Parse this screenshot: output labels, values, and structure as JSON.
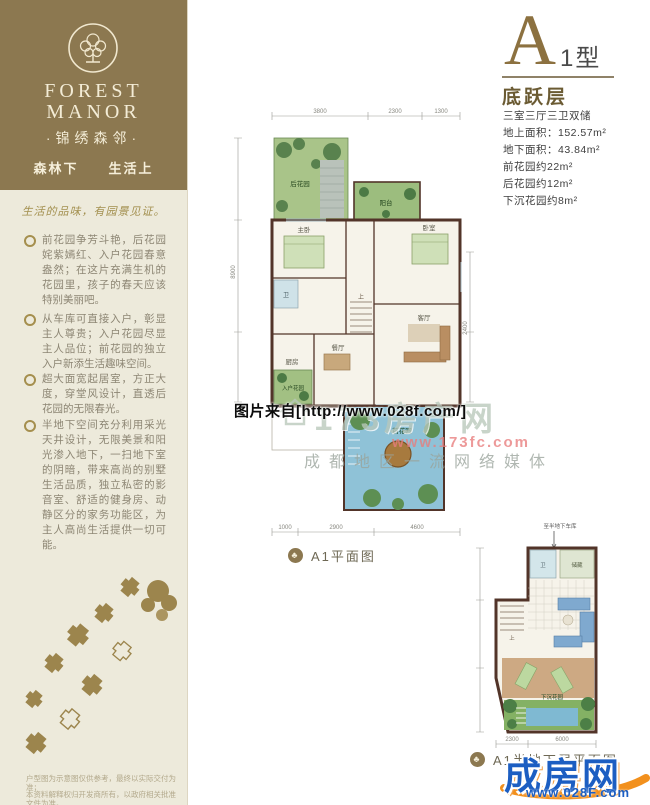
{
  "sidebar": {
    "brand_en_1": "FOREST",
    "brand_en_2": "MANOR",
    "brand_cn": "·锦绣森邻·",
    "tagline": "森林下　　生活上",
    "script_line": "生活的品味，有园景见证。",
    "bullets": [
      "前花园争芳斗艳，后花园姹紫嫣红、入户花园春意盎然；在这片充满生机的花园里，孩子的春天应该特别美丽吧。",
      "从车库可直接入户，彰显主人尊贵；入户花园尽显主人品位；前花园的独立入户新添生活趣味空间。",
      "超大面宽起居室，方正大度，穿堂风设计，直透后花园的无限春光。",
      "半地下空间充分利用采光天井设计，无限美景和阳光渗入地下，一扫地下室的阴暗，带来高尚的别墅生活品质，独立私密的影音室、舒适的健身房、动静区分的家务功能区，为主人高尚生活提供一切可能。"
    ],
    "disclaimers": [
      "户型图为示意图仅供参考，最终以实际交付为准；",
      "本资料解释权归开发商所有，以政府相关批准文件为准。"
    ]
  },
  "unit": {
    "letter": "A",
    "type": "1型",
    "floor": "底跃层",
    "specs": [
      "三室三厅三卫双储",
      "地上面积：152.57m²",
      "地下面积：43.84m²",
      "前花园约22m²",
      "后花园约12m²",
      "下沉花园约8m²"
    ]
  },
  "plan_main": {
    "caption": "A1平面图",
    "emblem_glyph": "♣",
    "rooms": {
      "back_garden": "后花园",
      "balcony": "阳台",
      "master": "主卧",
      "bedroom": "卧室",
      "bath": "卫",
      "dining": "餐厅",
      "living": "客厅",
      "kitchen": "厨房",
      "entry_garden": "入户花园",
      "front_garden": "前花园",
      "stairs_up": "上"
    },
    "dims_top": [
      "3800",
      "2300",
      "1300"
    ],
    "dims_bottom": [
      "1000",
      "2900",
      "4600"
    ],
    "dims_left": [
      "8900"
    ],
    "dims_right": [
      "2400"
    ]
  },
  "plan_basement": {
    "caption": "A1半地下层平面图",
    "top_note": "至半地下车库",
    "stairs_up": "上",
    "rooms": {
      "bath": "卫",
      "storage": "储藏",
      "sunken_garden": "下沉花园"
    },
    "dims_bottom": [
      "2300",
      "6000"
    ]
  },
  "watermarks": {
    "photo_credit": "图片来自[http://www.028f.com/]",
    "portal_name": "173房产网",
    "portal_url": "www.173fc.com",
    "portal_slogan": "成都地区一流网络媒体",
    "footer_logo_text": "成房网",
    "footer_logo_url": "www.028F.com"
  },
  "colors": {
    "sidebar_dark": "#8c7850",
    "sidebar_beige": "#edeadb",
    "accent_gold": "#a58f4e",
    "plan_wall": "#523429",
    "logo_blue": "#1c5ec2",
    "logo_orange": "#f2901d"
  }
}
